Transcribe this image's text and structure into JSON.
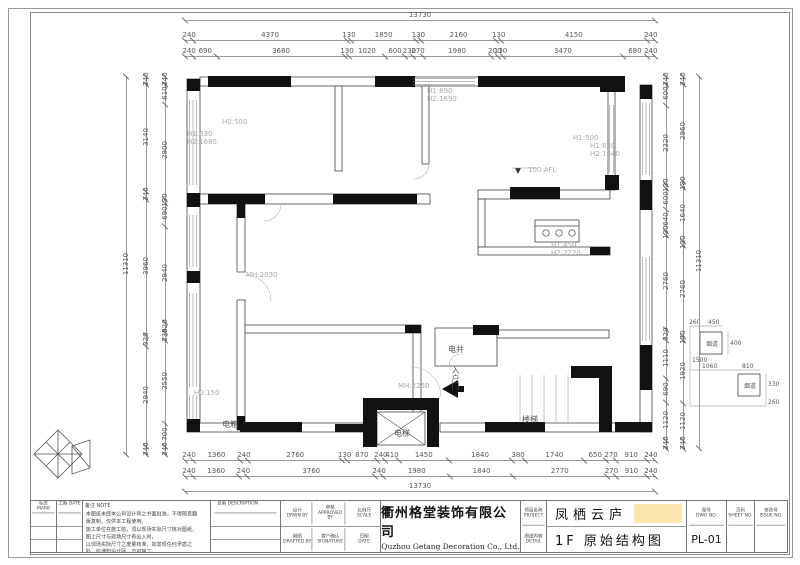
{
  "dims": {
    "top_total": "13730",
    "top_r2": [
      "240",
      "4370",
      "130",
      "1850",
      "130",
      "2160",
      "130",
      "4150",
      "240"
    ],
    "top_r3": [
      "240",
      "690",
      "3680",
      "130",
      "1020",
      "600",
      "230",
      "270",
      "1980",
      "200",
      "130",
      "3470",
      "680",
      "240"
    ],
    "bot_r1": [
      "240",
      "1360",
      "240",
      "2760",
      "130",
      "870",
      "240",
      "410",
      "1450",
      "1840",
      "380",
      "1740",
      "650",
      "270",
      "910",
      "240"
    ],
    "bot_r2": [
      "240",
      "1360",
      "240",
      "3760",
      "240",
      "1980",
      "1840",
      "2770",
      "270",
      "910",
      "240"
    ],
    "bot_total": "13730",
    "left_total": "11310",
    "left_r2": [
      "240",
      "3140",
      "240",
      "3960",
      "320",
      "2940",
      "240"
    ],
    "left_r3": [
      "240",
      "610",
      "2900",
      "130",
      "690",
      "2940",
      "320",
      "230",
      "2550",
      "700",
      "240"
    ],
    "right_r1": [
      "240",
      "600",
      "2320",
      "130",
      "600",
      "640",
      "130",
      "2760",
      "320",
      "1110",
      "690",
      "1120",
      "240"
    ],
    "right_r2": [
      "240",
      "2960",
      "180",
      "1640",
      "130",
      "2760",
      "140",
      "1920",
      "1120",
      "240"
    ],
    "right_total": "11310"
  },
  "annotations": {
    "h0500": "H0:500",
    "h1630": "H1:630",
    "h21680": "H2:1680",
    "h1690": "H1:690",
    "h21690": "H2:1690",
    "afl": "100 AFL",
    "h1500": "H1:500",
    "h1620": "H1:620",
    "h21640": "H2:1640",
    "h1450": "H1:450",
    "h22220": "H2:2220",
    "mh2030": "MH:2030",
    "mh2250": "MH:2250",
    "h0150": "H0:150",
    "shaft": "电井",
    "entry": "入户门",
    "elevator": "电梯",
    "stairs": "楼梯",
    "panel": "电箱"
  },
  "detail": {
    "flue1": "烟道",
    "flue2": "烟道",
    "d260a": "260",
    "d450": "450",
    "d400": "400",
    "d1060": "1060",
    "d810": "810",
    "d1500": "1500",
    "d330": "330",
    "d260b": "260"
  },
  "tb": {
    "mark_cn": "标志",
    "mark_en": "MARK",
    "date_cn": "工期",
    "date_en": "DATE",
    "notes_cn": "备注",
    "notes_en": "NOTE",
    "notes": [
      "本图纸未经本公司设计师之书面批准，不得随意翻版复制，仅供本工程使用。",
      "施工单位在施工前，须以现场实际尺寸核对图纸，图上尺寸与现场尺寸有出入时，",
      "以现场实际尺寸之度量核准，如发现任何矛盾之处，应通知设计师，方可施工。",
      "否则施工中的误差责任由施工方承担。"
    ],
    "desc_cn": "说明",
    "desc_en": "DESCRIPTION",
    "design_cn": "设计",
    "design_en": "DRWN BY",
    "check_cn": "审核",
    "check_en": "APPROVED BY",
    "scale_cn": "比例尺",
    "scale_en": "SCALE",
    "draft_cn": "制图",
    "draft_en": "DRAFTED BY",
    "confirm_cn": "客户确认",
    "confirm_en": "SIGNATURE",
    "date2_cn": "日期",
    "date2_en": "DATE",
    "company_cn": "衢州格堂装饰有限公司",
    "company_en": "Quzhou Getang Decoration Co., Ltd.",
    "proj_label_cn": "项目名称",
    "proj_label_en": "PROJECT",
    "draw_label_cn": "图纸内容",
    "draw_label_en": "DETAIL",
    "project_name": "凤栖云庐",
    "drawing_name": "1F 原始结构图",
    "dwgno_cn": "图号",
    "dwgno_en": "DWG NO.",
    "dwgno": "PL-01",
    "sheetno_cn": "页码",
    "sheetno_en": "SHEET NO.",
    "issue_cn": "修改号",
    "issue_en": "ISSUE NO."
  }
}
